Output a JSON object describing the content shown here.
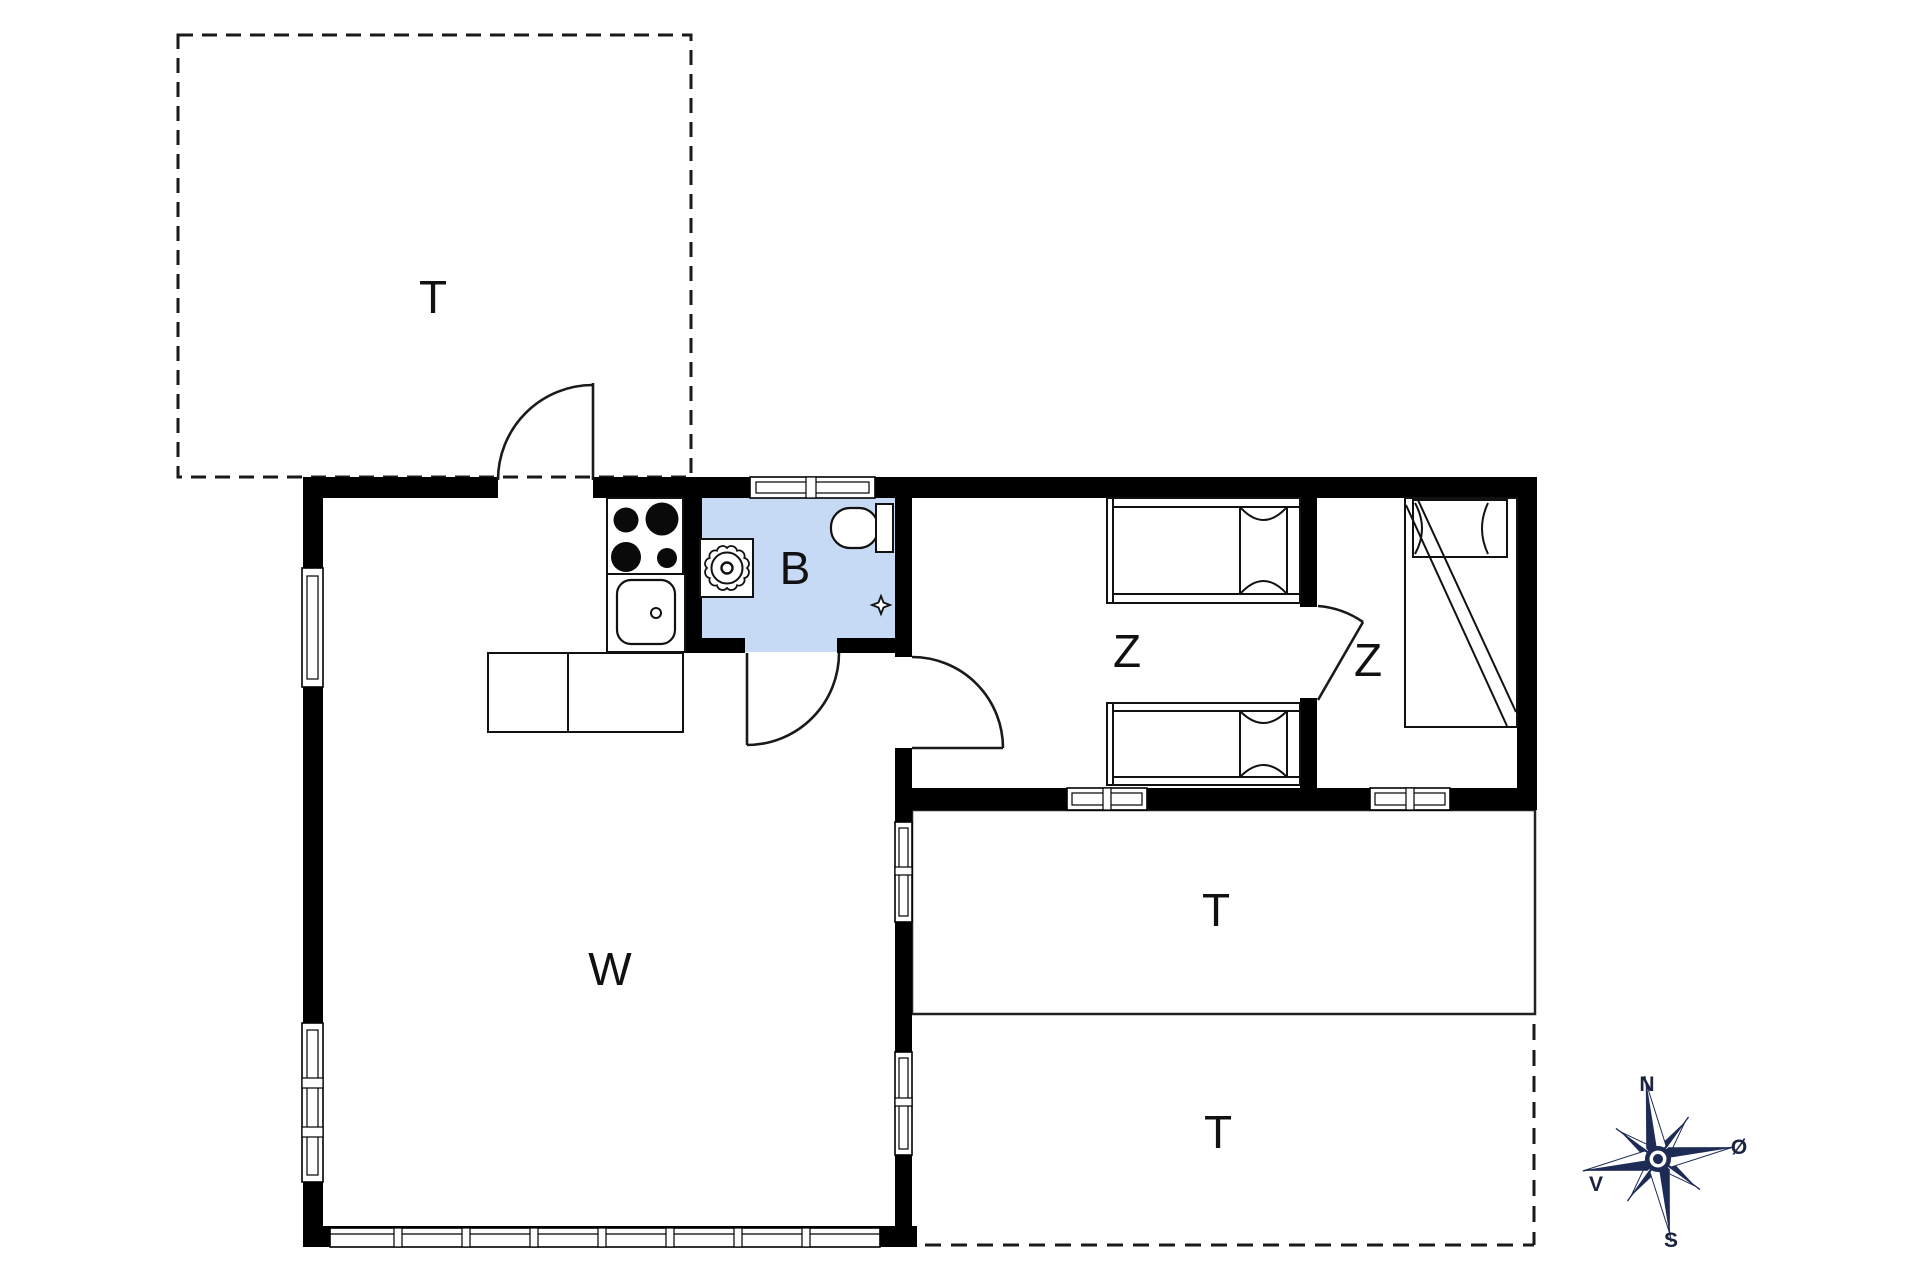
{
  "plan": {
    "rooms": [
      {
        "id": "terrace-northwest",
        "label": "T"
      },
      {
        "id": "bathroom",
        "label": "B"
      },
      {
        "id": "bedroom-1",
        "label": "Z"
      },
      {
        "id": "bedroom-2",
        "label": "Z"
      },
      {
        "id": "terrace-middle",
        "label": "T"
      },
      {
        "id": "terrace-south",
        "label": "T"
      },
      {
        "id": "living-room",
        "label": "W"
      }
    ],
    "compass": {
      "north": "N",
      "south": "S",
      "east": "Ø",
      "west": "V"
    },
    "colors": {
      "wall": "#000000",
      "bathroom_fill": "#c6daf6",
      "compass_navy": "#1e2c55",
      "background": "#ffffff",
      "line": "#1a1a1a"
    }
  }
}
